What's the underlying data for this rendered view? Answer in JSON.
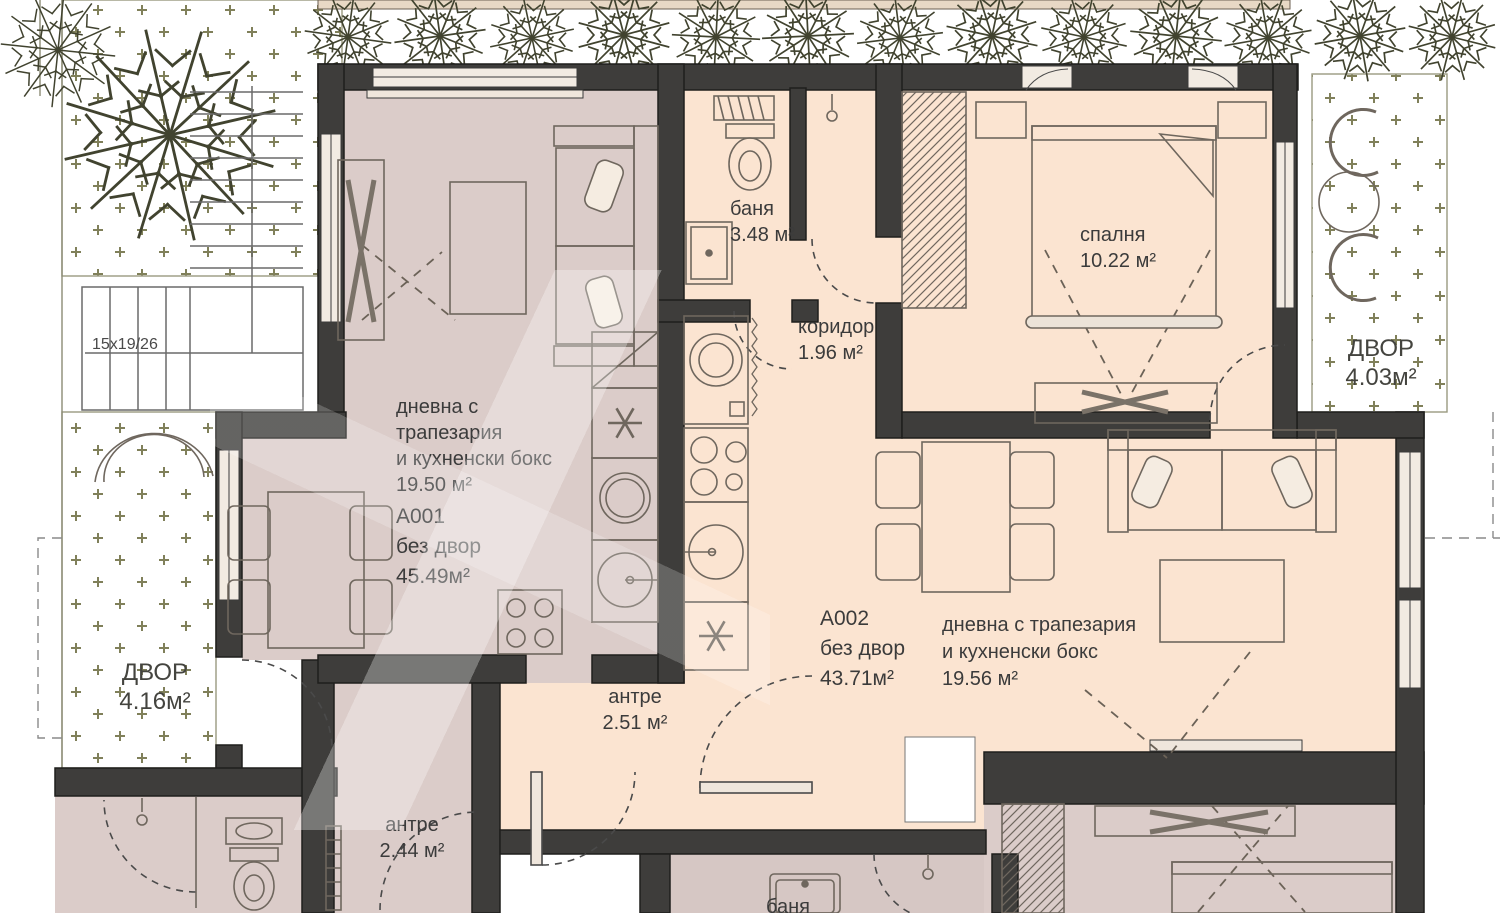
{
  "colors": {
    "wall": "#3e3d3b",
    "a001_fill": "#dbccc9",
    "a002_fill": "#fbe4d1",
    "garden_bg": "#fdfdf2",
    "garden_mark": "#80805a",
    "furniture_line": "#6f675e",
    "text": "#3b3b3b"
  },
  "stairs": {
    "label": "15x19/26"
  },
  "yards": [
    {
      "id": "yard-left",
      "name": "ДВОР",
      "area": "4.16м²"
    },
    {
      "id": "yard-right",
      "name": "ДВОР",
      "area": "4.03м²"
    }
  ],
  "apartments": [
    {
      "code": "A001",
      "note": "без двор",
      "total_area": "45.49м²",
      "living_label": {
        "lines": [
          "дневна с",
          "трапезария",
          "и кухненски бокс"
        ],
        "area": "19.50 м²"
      }
    },
    {
      "code": "A002",
      "note": "без двор",
      "total_area": "43.71м²",
      "living_label": {
        "lines": [
          "дневна с трапезария",
          "и кухненски бокс"
        ],
        "area": "19.56 м²"
      }
    }
  ],
  "rooms": [
    {
      "id": "bathroom-top",
      "name": "баня",
      "area": "3.48 м²"
    },
    {
      "id": "corridor",
      "name": "коридор",
      "area": "1.96 м²"
    },
    {
      "id": "bedroom",
      "name": "спалня",
      "area": "10.22 м²"
    },
    {
      "id": "hall-a002",
      "name": "антре",
      "area": "2.51 м²"
    },
    {
      "id": "hall-a001",
      "name": "антре",
      "area": "2.44 м²"
    },
    {
      "id": "bathroom-bottom",
      "name": "баня"
    }
  ]
}
